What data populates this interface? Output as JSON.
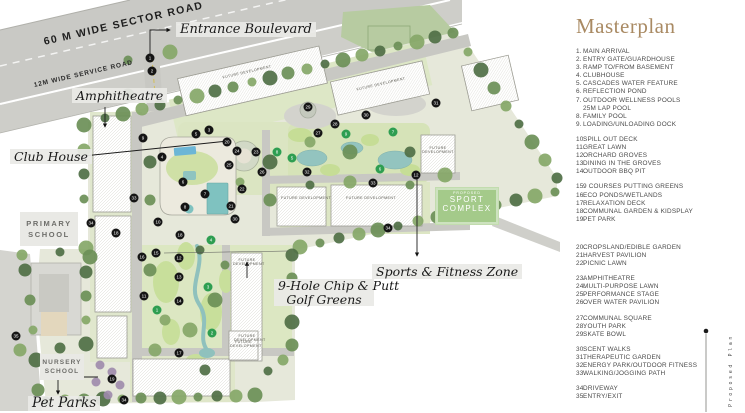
{
  "map": {
    "roads": {
      "sector": "60 M WIDE SECTOR ROAD",
      "service": "12M WIDE SERVICE ROAD"
    },
    "labels": {
      "entrance_boulevard": "Entrance Boulevard",
      "amphitheatre": "Amphitheatre",
      "club_house": "Club House",
      "golf_line1": "9-Hole Chip & Putt",
      "golf_line2": "Golf Greens",
      "sports_fitness_zone": "Sports & Fitness Zone",
      "pet_parks": "Pet Parks",
      "primary_school_line1": "PRIMARY",
      "primary_school_line2": "SCHOOL",
      "nursery_school_line1": "NURSERY",
      "nursery_school_line2": "SCHOOL",
      "future_development": "FUTURE DEVELOPMENT",
      "future_line1": "FUTURE",
      "future_line2": "DEVELOPMENT"
    },
    "sport_complex": {
      "tag": "PROPOSED",
      "line1": "SPORT",
      "line2": "COMPLEX",
      "color": "#a4ca8a"
    },
    "marker_colors": {
      "black": "#151515",
      "green": "#2e9e51"
    },
    "markers": [
      {
        "n": 1,
        "x": 150,
        "y": 58
      },
      {
        "n": 2,
        "x": 152,
        "y": 71
      },
      {
        "n": 3,
        "x": 209,
        "y": 130
      },
      {
        "n": 5,
        "x": 196,
        "y": 134
      },
      {
        "n": 9,
        "x": 143,
        "y": 138
      },
      {
        "n": 4,
        "x": 162,
        "y": 157
      },
      {
        "n": 20,
        "x": 227,
        "y": 142
      },
      {
        "n": 24,
        "x": 237,
        "y": 151
      },
      {
        "n": 23,
        "x": 256,
        "y": 152
      },
      {
        "n": 25,
        "x": 229,
        "y": 165
      },
      {
        "n": 26,
        "x": 262,
        "y": 172
      },
      {
        "n": 6,
        "x": 183,
        "y": 182
      },
      {
        "n": 7,
        "x": 205,
        "y": 194
      },
      {
        "n": 22,
        "x": 242,
        "y": 189
      },
      {
        "n": 8,
        "x": 185,
        "y": 207
      },
      {
        "n": 21,
        "x": 231,
        "y": 206
      },
      {
        "n": 30,
        "x": 235,
        "y": 219
      },
      {
        "n": 10,
        "x": 158,
        "y": 222
      },
      {
        "n": 33,
        "x": 134,
        "y": 198
      },
      {
        "n": 34,
        "x": 91,
        "y": 223
      },
      {
        "n": 18,
        "x": 116,
        "y": 233
      },
      {
        "n": 18,
        "x": 180,
        "y": 235
      },
      {
        "n": 15,
        "x": 156,
        "y": 253
      },
      {
        "n": 16,
        "x": 142,
        "y": 257
      },
      {
        "n": 12,
        "x": 179,
        "y": 258
      },
      {
        "n": 13,
        "x": 179,
        "y": 277
      },
      {
        "n": 11,
        "x": 144,
        "y": 296
      },
      {
        "n": 14,
        "x": 179,
        "y": 301
      },
      {
        "n": 17,
        "x": 179,
        "y": 353
      },
      {
        "n": 19,
        "x": 112,
        "y": 379
      },
      {
        "n": 34,
        "x": 124,
        "y": 400
      },
      {
        "n": 35,
        "x": 16,
        "y": 336
      },
      {
        "n": 29,
        "x": 308,
        "y": 107
      },
      {
        "n": 30,
        "x": 366,
        "y": 115
      },
      {
        "n": 31,
        "x": 436,
        "y": 103
      },
      {
        "n": 27,
        "x": 318,
        "y": 133
      },
      {
        "n": 28,
        "x": 335,
        "y": 124
      },
      {
        "n": 32,
        "x": 307,
        "y": 172
      },
      {
        "n": 33,
        "x": 373,
        "y": 183
      },
      {
        "n": 12,
        "x": 416,
        "y": 175
      },
      {
        "n": 34,
        "x": 388,
        "y": 228
      },
      {
        "n": 1,
        "x": 157,
        "y": 310,
        "green": true
      },
      {
        "n": 2,
        "x": 212,
        "y": 333,
        "green": true
      },
      {
        "n": 3,
        "x": 208,
        "y": 287,
        "green": true
      },
      {
        "n": 4,
        "x": 211,
        "y": 240,
        "green": true
      },
      {
        "n": 5,
        "x": 292,
        "y": 158,
        "green": true
      },
      {
        "n": 6,
        "x": 380,
        "y": 169,
        "green": true
      },
      {
        "n": 7,
        "x": 393,
        "y": 132,
        "green": true
      },
      {
        "n": 8,
        "x": 277,
        "y": 152,
        "green": true
      },
      {
        "n": 9,
        "x": 346,
        "y": 134,
        "green": true
      }
    ]
  },
  "legend": {
    "title": "Masterplan",
    "title_color": "#a98a63",
    "groups": [
      {
        "items": [
          {
            "n": "1.",
            "t": "MAIN ARRIVAL"
          },
          {
            "n": "2.",
            "t": "ENTRY GATE/GUARDHOUSE"
          },
          {
            "n": "3.",
            "t": "RAMP TO/FROM BASEMENT"
          },
          {
            "n": "4.",
            "t": "CLUBHOUSE"
          },
          {
            "n": "5.",
            "t": "CASCADES WATER FEATURE"
          },
          {
            "n": "6.",
            "t": "REFLECTION POND"
          },
          {
            "n": "7.",
            "t": "OUTDOOR WELLNESS POOLS"
          },
          {
            "n": "",
            "t": "25M LAP POOL"
          },
          {
            "n": "8.",
            "t": "FAMILY POOL"
          },
          {
            "n": "9.",
            "t": "LOADING/UNLOADING DOCK"
          }
        ]
      },
      {
        "items": [
          {
            "n": "10.",
            "t": "SPILL OUT DECK"
          },
          {
            "n": "11.",
            "t": "GREAT LAWN"
          },
          {
            "n": "12.",
            "t": "ORCHARD GROVES"
          },
          {
            "n": "13.",
            "t": "DINING IN THE GROVES"
          },
          {
            "n": "14.",
            "t": "OUTDOOR BBQ PIT"
          }
        ]
      },
      {
        "items": [
          {
            "n": "15.",
            "t": "9 COURSES PUTTING GREENS"
          },
          {
            "n": "16.",
            "t": "ECO PONDS/WETLANDS"
          },
          {
            "n": "17.",
            "t": "RELAXATION DECK"
          },
          {
            "n": "18.",
            "t": "COMMUNAL GARDEN & KIDSPLAY"
          },
          {
            "n": "19.",
            "t": "PET PARK"
          }
        ]
      },
      {
        "big": true,
        "items": [
          {
            "n": "20.",
            "t": "CROPSLAND/EDIBLE GARDEN"
          },
          {
            "n": "21.",
            "t": "HARVEST PAVILION"
          },
          {
            "n": "22.",
            "t": "PICNIC LAWN"
          }
        ]
      },
      {
        "items": [
          {
            "n": "23.",
            "t": "AMPHITHEATRE"
          },
          {
            "n": "24.",
            "t": "MULTI-PURPOSE LAWN"
          },
          {
            "n": "25.",
            "t": "PERFORMANCE STAGE"
          },
          {
            "n": "26.",
            "t": "OVER WATER PAVILION"
          }
        ]
      },
      {
        "items": [
          {
            "n": "27.",
            "t": "COMMUNAL SQUARE"
          },
          {
            "n": "28.",
            "t": "YOUTH PARK"
          },
          {
            "n": "29.",
            "t": "SKATE BOWL"
          }
        ]
      },
      {
        "items": [
          {
            "n": "30.",
            "t": "SCENT WALKS"
          },
          {
            "n": "31.",
            "t": "THERAPEUTIC GARDEN"
          },
          {
            "n": "32.",
            "t": "ENERGY PARK/OUTDOOR FITNESS"
          },
          {
            "n": "33.",
            "t": "WALKING/JOGGING PATH"
          }
        ]
      },
      {
        "items": [
          {
            "n": "34.",
            "t": "DRIVEWAY"
          },
          {
            "n": "35.",
            "t": "ENTRY/EXIT"
          }
        ]
      }
    ]
  },
  "side_text": "Proposed Plan"
}
